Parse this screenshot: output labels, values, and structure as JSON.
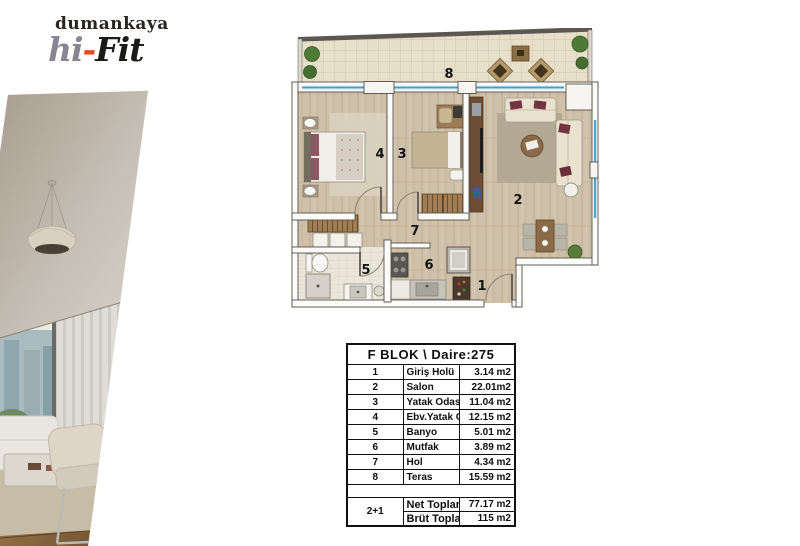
{
  "brand": {
    "name": "dumankaya",
    "product_prefix": "hi",
    "product_dash": "-",
    "product_suffix": "Fit",
    "colors": {
      "accent_orange": "#e8491f",
      "logo_gray": "#8b8492",
      "ink": "#1d1b1a"
    }
  },
  "floor_plan": {
    "room_numbers": {
      "giris_holu": "1",
      "salon": "2",
      "yatak_odasi": "3",
      "ebv_yatak_odasi": "4",
      "banyo": "5",
      "mutfak": "6",
      "hol": "7",
      "teras": "8"
    },
    "colors": {
      "window_glass_blue": "#3f9fc4",
      "wood_floor": "#cfc1a9",
      "terrace_tile": "#e7dfc9",
      "wall_dark": "#55514b"
    }
  },
  "table": {
    "header": "F BLOK \\ Daire:275",
    "rows": [
      {
        "num": "1",
        "name": "Giriş Holü",
        "area": "3.14 m2"
      },
      {
        "num": "2",
        "name": "Salon",
        "area": "22.01m2"
      },
      {
        "num": "3",
        "name": "Yatak Odası",
        "area": "11.04 m2"
      },
      {
        "num": "4",
        "name": "Ebv.Yatak Odası",
        "area": "12.15 m2"
      },
      {
        "num": "5",
        "name": "Banyo",
        "area": "5.01 m2"
      },
      {
        "num": "6",
        "name": "Mutfak",
        "area": "3.89 m2"
      },
      {
        "num": "7",
        "name": "Hol",
        "area": "4.34 m2"
      },
      {
        "num": "8",
        "name": "Teras",
        "area": "15.59 m2"
      }
    ],
    "summary": {
      "type_label": "2+1",
      "net_label": "Net Toplam",
      "net_value": "77.17 m2",
      "brut_label": "Brüt Toplam",
      "brut_value": "115 m2"
    }
  }
}
